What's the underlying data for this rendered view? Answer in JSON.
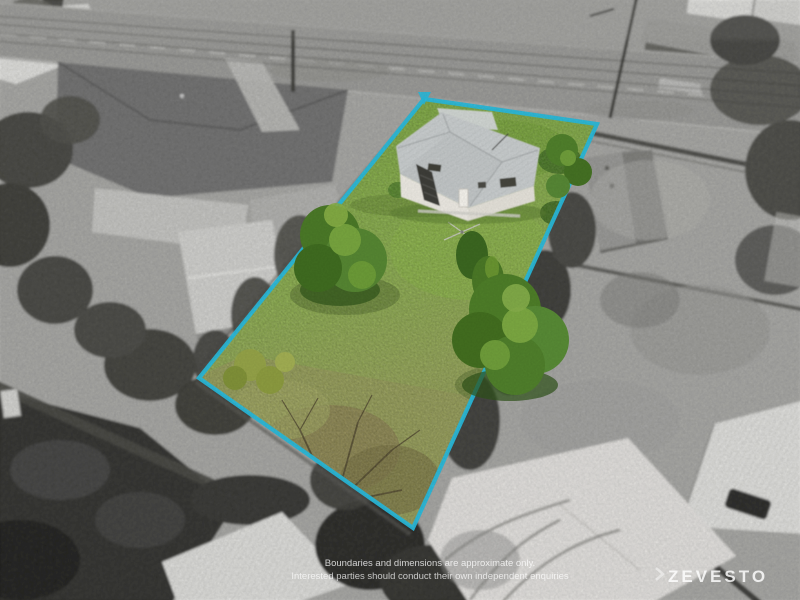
{
  "overlay": {
    "disclaimer_line1": "Boundaries and dimensions are approximate only.",
    "disclaimer_line2": "Interested parties should conduct their own independent enquiries",
    "watermark": "ZEVESTO"
  },
  "colors": {
    "boundary_accent": "#29b7d8",
    "lawn_light": "#8fb84c",
    "lawn_dark": "#6d9639",
    "scrub_olive": "#99a15c",
    "tree_green": "#4d7c28",
    "house_roof_gray": "#c6cacb",
    "house_wall_white": "#e9e6df",
    "surroundings": "grayscale"
  },
  "scene": {
    "description_labels": {
      "property_boundary": "highlighted lot boundary",
      "house": "two-storey house with metal hip roof",
      "road": "street at top of frame"
    }
  }
}
